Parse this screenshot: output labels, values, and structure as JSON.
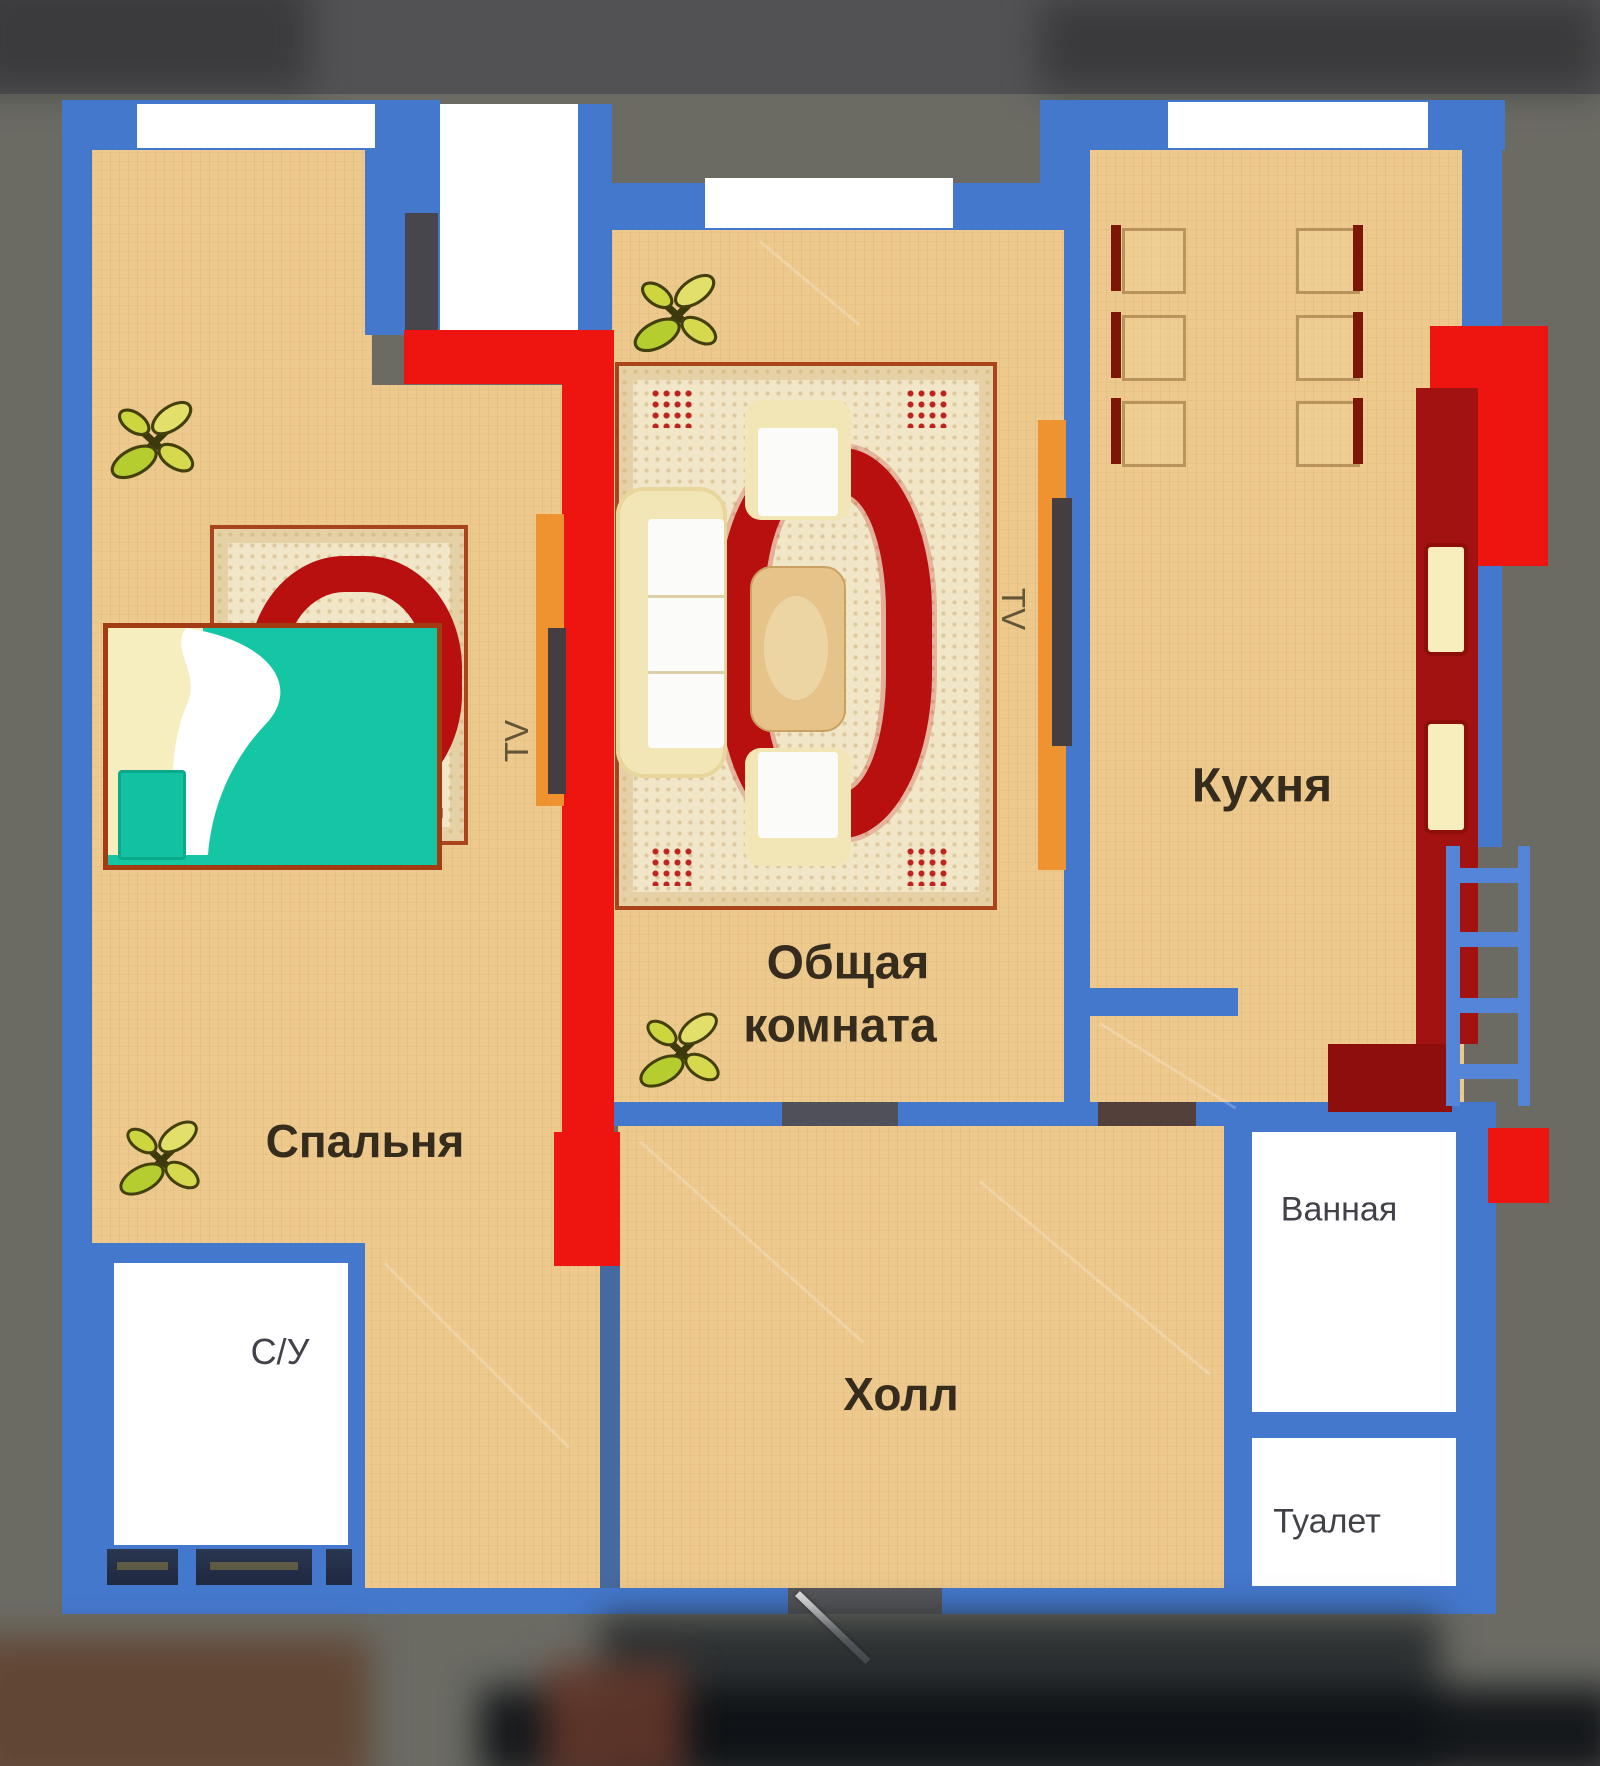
{
  "title": "apartment floor plan",
  "labels": {
    "bedroom": "Спальня",
    "living_line1": "Общая",
    "living_line2": "комната",
    "kitchen": "Кухня",
    "hall": "Холл",
    "wc": "С/У",
    "bathroom": "Ванная",
    "toilet": "Туалет",
    "tv_bedroom": "TV",
    "tv_living": "TV"
  },
  "colors": {
    "outer_wall": "#4478cd",
    "accent_wall": "#ee1510",
    "kitchen_counter": "#a11210",
    "floor": "#edc98d",
    "carpet_base": "#f1e6c7",
    "carpet_pattern": "#b80f0f",
    "bed_blanket": "#15c6a5",
    "sofa_cream": "#f3e6b6",
    "plant_green": "#c3cf33",
    "background": "#6b6b64"
  }
}
